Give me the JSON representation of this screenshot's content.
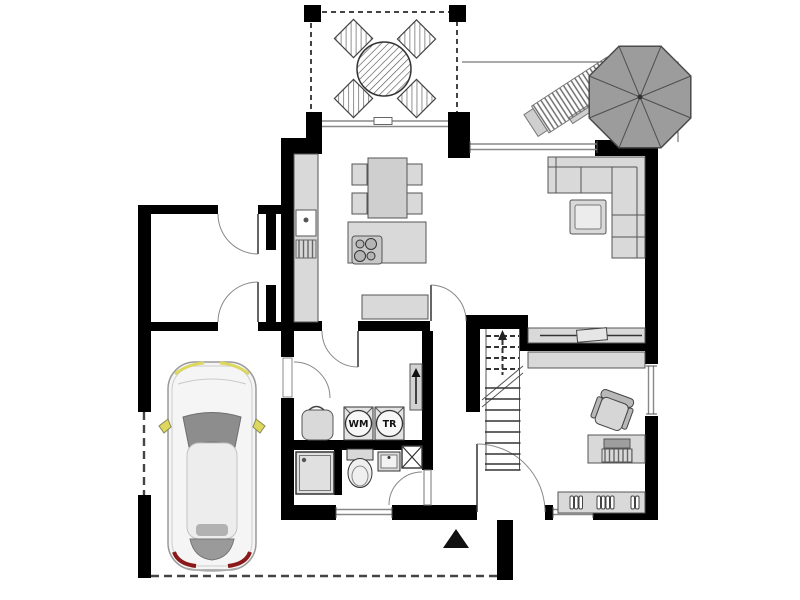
{
  "plan": {
    "type": "residential ground floor plan, top-down architectural drawing",
    "appliance_labels": {
      "washing_machine": "WM",
      "dryer": "TR"
    },
    "annotations": {
      "entrance_marker": "filled triangle pointing up at main entrance",
      "stairs_direction": "up arrow on dashed walk line of staircase"
    },
    "colors": {
      "wall": "#000000",
      "furniture": "#d9d9d9",
      "furniture_light": "#ececec",
      "parasol": "#9c9c9c",
      "car_body": "#f5f5f5",
      "accent_yellow": "#ddd75e",
      "accent_red": "#8a1a1a",
      "dash": "#444444",
      "background": "#ffffff"
    }
  }
}
